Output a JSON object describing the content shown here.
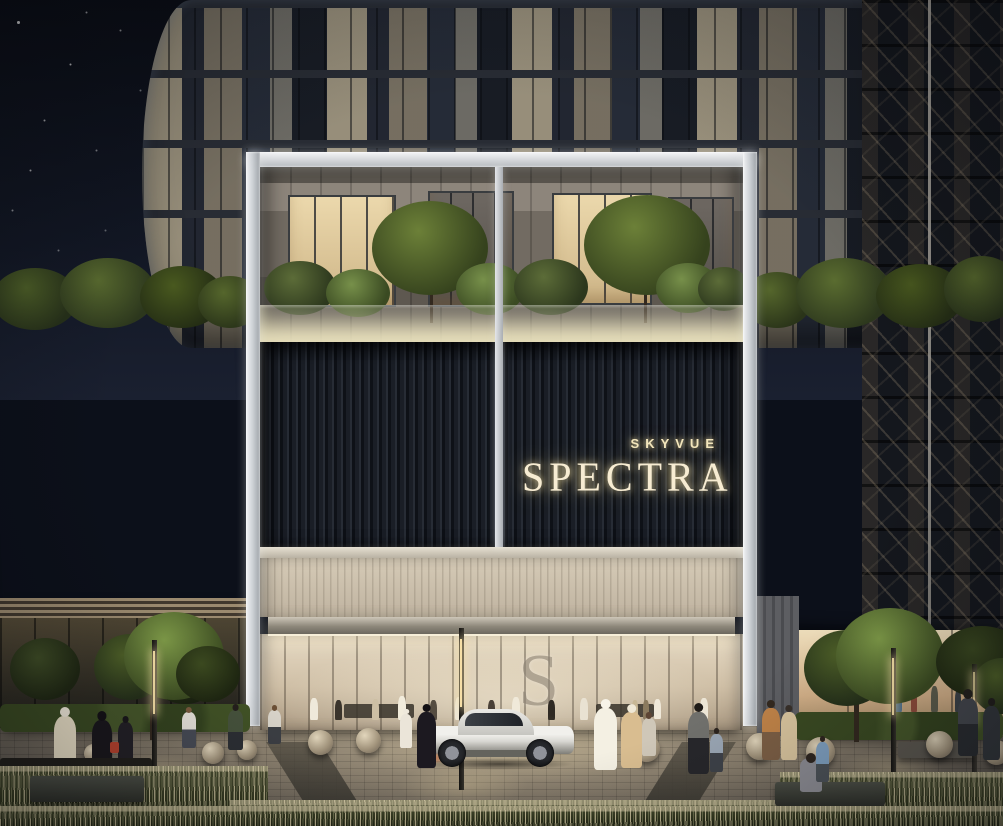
{
  "scene": {
    "description": "Night architectural rendering of the SKYVUE SPECTRA residential tower street entrance: silver portal frame with planted terrace, black slatted signage wall with glowing gold lettering, warm glass lobby with S monogram, striped stone podium wings with rooftop hedges, retail storefronts, plaza with stone sphere bollards, lamp posts, a white supercar and pedestrians in Emirati and casual dress",
    "signage": {
      "brand_line": "SKYVUE",
      "name_line": "SPECTRA"
    },
    "lobby_monogram": "S",
    "palette": {
      "sky": "#0c101a",
      "sign_gold": "#f5e8c4",
      "frame_silver": "#e9ebed",
      "slat_wall": "#12151c",
      "podium_cream": "#ead9b6",
      "podium_tan": "#c8a576",
      "podium_brown": "#7a6750",
      "lobby_glow": "#ddcfb8",
      "foliage_green": "#4c5c30",
      "pavement": "#6e675c",
      "car_body": "#e6e5e1",
      "accent_red_bag": "#b8432e"
    }
  }
}
